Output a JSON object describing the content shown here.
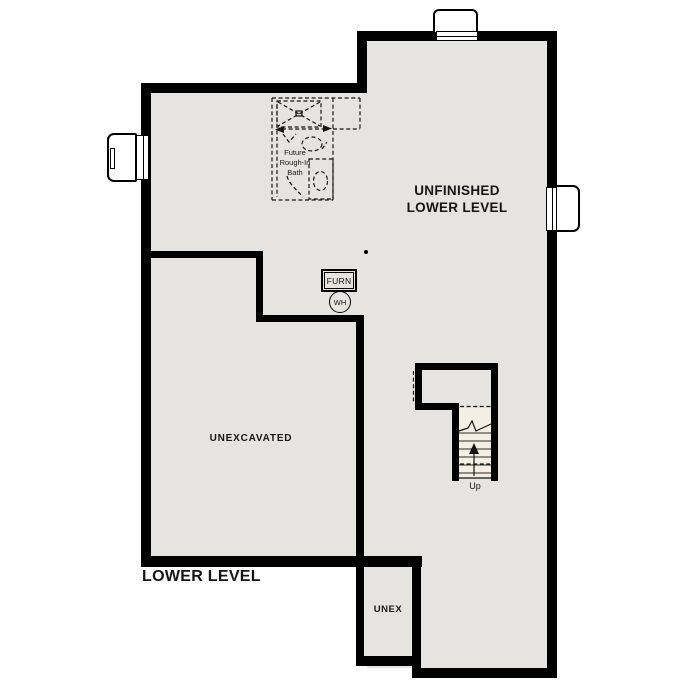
{
  "meta": {
    "title": "Lower Level Floor Plan"
  },
  "colors": {
    "wall": "#000000",
    "floor": "#e5e4e1",
    "stair-fill": "#f4efe2",
    "ink": "#151515",
    "paper": "#ffffff"
  },
  "labels": {
    "room_main": {
      "line1": "UNFINISHED",
      "line2": "LOWER LEVEL"
    },
    "room_unexcavated": "UNEXCAVATED",
    "room_unex_small": "UNEX",
    "plan_title": "LOWER LEVEL",
    "future_bath": {
      "line1": "Future",
      "line2": "Rough-In",
      "line3": "Bath"
    },
    "furnace": "FURN",
    "water_heater": "WH",
    "stairs_direction": "Up"
  }
}
